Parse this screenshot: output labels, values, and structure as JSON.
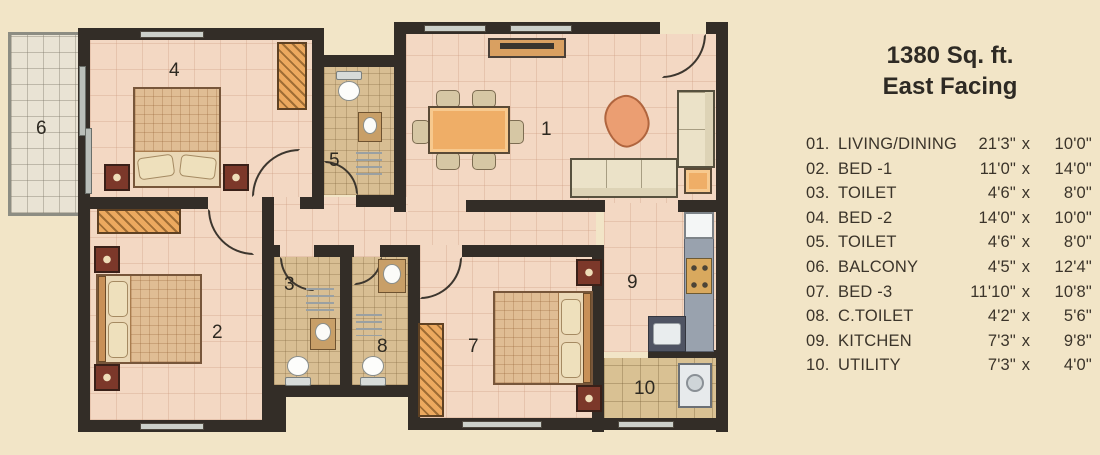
{
  "title": {
    "line1": "1380 Sq. ft.",
    "line2": "East Facing"
  },
  "legend": {
    "sep": "x",
    "items": [
      {
        "index": "01.",
        "name": "LIVING/DINING",
        "w": "21'3\"",
        "h": "10'0\""
      },
      {
        "index": "02.",
        "name": "BED -1",
        "w": "11'0\"",
        "h": "14'0\""
      },
      {
        "index": "03.",
        "name": "TOILET",
        "w": "4'6\"",
        "h": "8'0\""
      },
      {
        "index": "04.",
        "name": "BED -2",
        "w": "14'0\"",
        "h": "10'0\""
      },
      {
        "index": "05.",
        "name": "TOILET",
        "w": "4'6\"",
        "h": "8'0\""
      },
      {
        "index": "06.",
        "name": "BALCONY",
        "w": "4'5\"",
        "h": "12'4\""
      },
      {
        "index": "07.",
        "name": "BED -3",
        "w": "11'10\"",
        "h": "10'8\""
      },
      {
        "index": "08.",
        "name": "C.TOILET",
        "w": "4'2\"",
        "h": "5'6\""
      },
      {
        "index": "09.",
        "name": "KITCHEN",
        "w": "7'3\"",
        "h": "9'8\""
      },
      {
        "index": "10.",
        "name": "UTILITY",
        "w": "7'3\"",
        "h": "4'0\""
      }
    ]
  },
  "plan": {
    "rooms": [
      {
        "id": "living-dining",
        "label": "1"
      },
      {
        "id": "bed-1",
        "label": "2"
      },
      {
        "id": "toilet-1",
        "label": "3"
      },
      {
        "id": "bed-2",
        "label": "4"
      },
      {
        "id": "toilet-2",
        "label": "5"
      },
      {
        "id": "balcony",
        "label": "6"
      },
      {
        "id": "bed-3",
        "label": "7"
      },
      {
        "id": "c-toilet",
        "label": "8"
      },
      {
        "id": "kitchen",
        "label": "9"
      },
      {
        "id": "utility",
        "label": "10"
      }
    ]
  },
  "colors": {
    "wall": "#332d27",
    "floor": "#f3d8c3",
    "tile": "#d8be93",
    "balcony": "#e9e3d4",
    "background": "#f2e5c7",
    "wood": "#eca95f"
  }
}
